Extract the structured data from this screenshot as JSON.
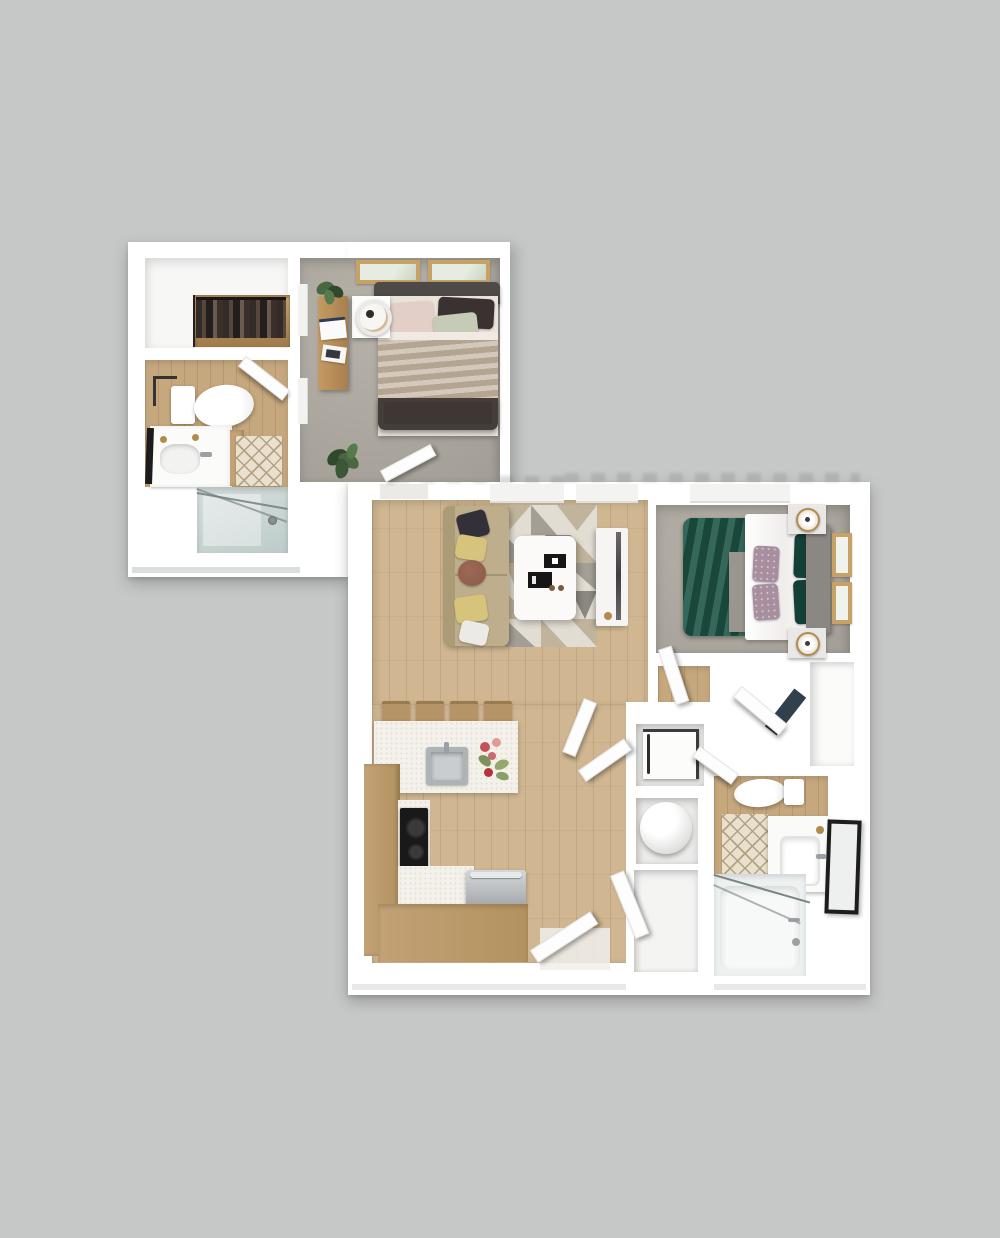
{
  "scene": {
    "kind": "3d-rendered-floor-plan",
    "description": "Top-down 3D rendering of a one-bedroom-plus-den style apartment shown as two connected white floor-plan blocks on a gray background; no text labels are rendered in the image",
    "blocks": [
      {
        "id": "bedroom-suite-block",
        "rooms": [
          {
            "name": "walk-in-closet",
            "contents": [
              "hanging-clothes-rod"
            ]
          },
          {
            "name": "bathroom-1",
            "contents": [
              "toilet",
              "vanity-with-sink",
              "leaning-mirror",
              "bath-mat",
              "side-cabinet",
              "door"
            ]
          },
          {
            "name": "shower-room",
            "contents": [
              "glass-shower-enclosure",
              "shower-head"
            ]
          },
          {
            "name": "bedroom-1",
            "contents": [
              "bed-with-dark-frame",
              "blush-pillow",
              "dark-pillow",
              "sage-pillow",
              "tan-blanket",
              "headboard",
              "nightstand",
              "table-lamp",
              "desk",
              "papers",
              "desk-plant",
              "floor-plant",
              "two-wall-art-frames",
              "window",
              "door"
            ]
          }
        ]
      },
      {
        "id": "main-living-block",
        "rooms": [
          {
            "name": "living-room",
            "contents": [
              "tan-sofa",
              "black-pillow",
              "yellow-pillows",
              "brown-pillow",
              "white-pillow",
              "geometric-area-rug",
              "white-coffee-table",
              "black-trays",
              "tv-console",
              "tv",
              "windows"
            ]
          },
          {
            "name": "kitchen",
            "contents": [
              "breakfast-bar",
              "four-bar-stools",
              "island-counter",
              "stainless-sink",
              "faucet",
              "flower-bouquet",
              "wood-cabinets",
              "black-cooktop",
              "stainless-oven",
              "speckled-counter"
            ]
          },
          {
            "name": "entry",
            "contents": [
              "entry-door",
              "closet-door"
            ]
          },
          {
            "name": "hallway",
            "contents": [
              "door-pair"
            ]
          },
          {
            "name": "bedroom-2",
            "contents": [
              "green-duvet-bed",
              "white-sheet",
              "floral-pillows",
              "dark-green-pillows",
              "gray-headboard",
              "two-nightstands",
              "two-gold-lamps",
              "two-wall-art-frames",
              "window",
              "door",
              "walk-in-closet"
            ]
          },
          {
            "name": "bathroom-2",
            "contents": [
              "toilet",
              "bath-mat",
              "vanity-with-rectangular-sink",
              "leaning-black-mirror",
              "bathtub-with-glass-screen",
              "tub-faucet",
              "door"
            ]
          },
          {
            "name": "utility-closets",
            "contents": [
              "front-load-washer",
              "round-water-heater",
              "empty-storage-closet"
            ]
          }
        ]
      }
    ]
  },
  "palette": {
    "bg": "#c6c7c7",
    "wall": "#ffffff",
    "wallEdge": "#dbdedf",
    "wood": "#d0b792",
    "woodDark": "#c6a87e",
    "carpet": "#b6b1a9",
    "carpetDark": "#a49f97",
    "counter": "#f3f1ea",
    "cabinet": "#c2a276",
    "stainless": "#b7bbbd",
    "steel": "#9aa0a3",
    "black": "#191919",
    "sofa": "#bfae8c",
    "sofaDark": "#ab9b77",
    "pillowYellow": "#d6c37c",
    "pillowBrown": "#8a5a49",
    "pillowBlack": "#34303a",
    "pillowWhite": "#eceae6",
    "duvet": "#1e5747",
    "duvetDark": "#143f36",
    "pillowFloral": "#a78fa0",
    "headboard": "#8b8884",
    "bedDark": "#453d39",
    "blanket": "#c2b19e",
    "pillowBlush": "#e2cfc7",
    "pillowSage": "#c5cbb7",
    "frame": "#c7a265",
    "mat": "#e9e1cd",
    "matLine": "#b2a184",
    "glass": "#c9d5d3",
    "glassEdge": "#6a7a78",
    "plant": "#4a6742",
    "plantDark": "#30492c",
    "gold": "#b28a4e",
    "rugBase": "#e2ddd3",
    "rugTan": "#c1b49c",
    "rugGray": "#a39f96",
    "rugDark": "#8b8880",
    "recess": "#ebebea"
  }
}
